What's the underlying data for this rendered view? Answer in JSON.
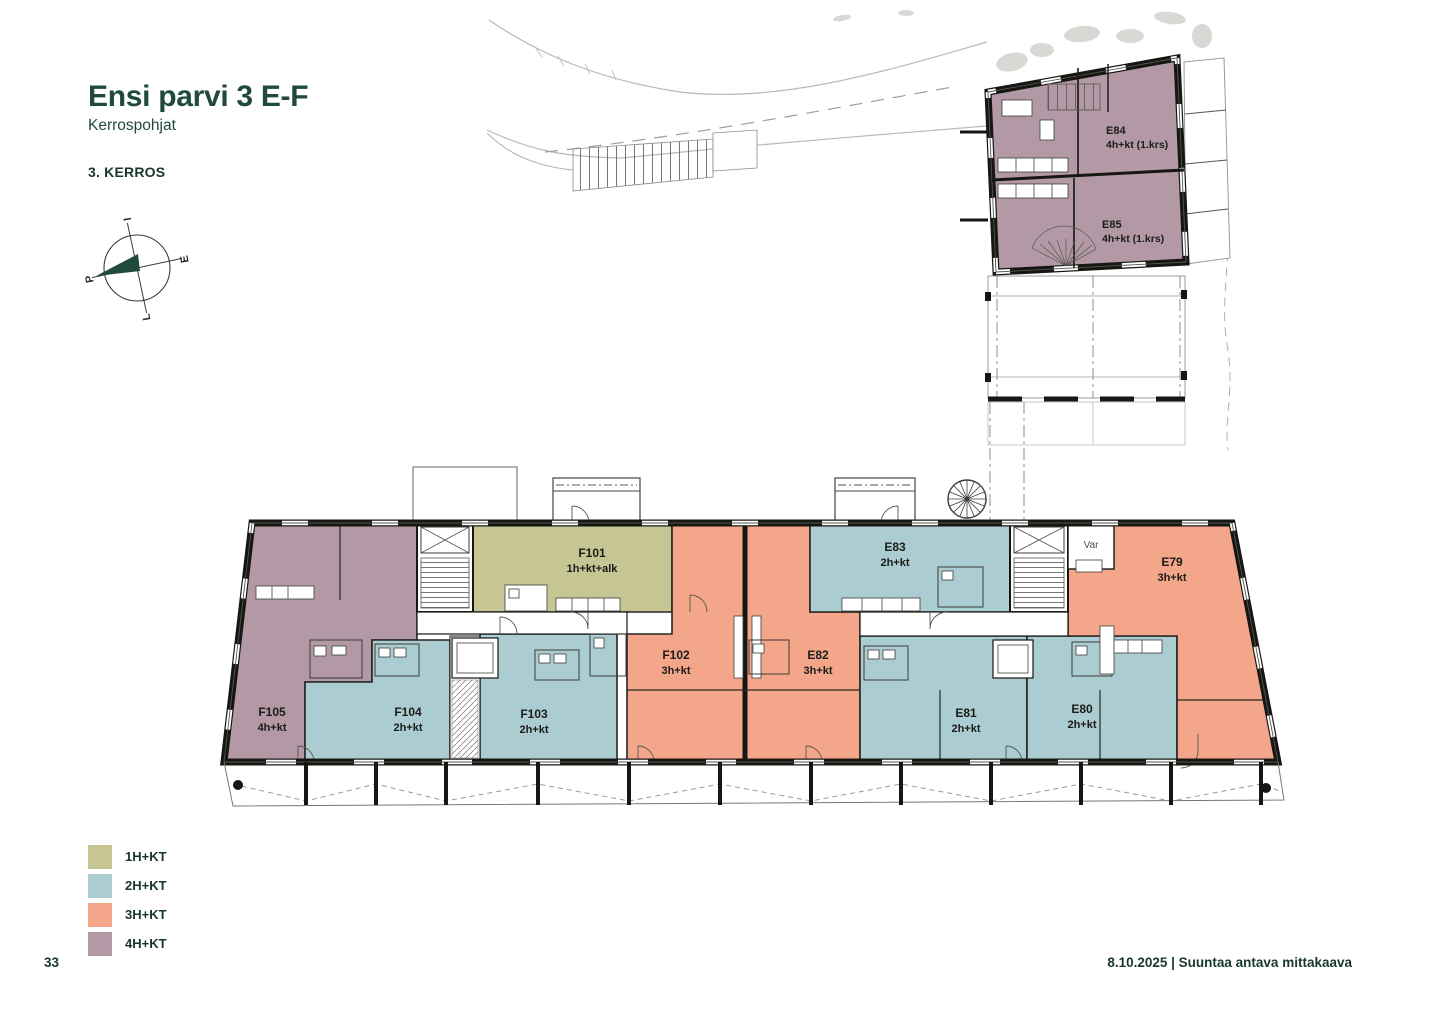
{
  "header": {
    "title": "Ensi parvi 3 E-F",
    "subtitle": "Kerrospohjat",
    "floor_label": "3. KERROS"
  },
  "compass": {
    "top": "I",
    "right": "E",
    "bottom": "L",
    "left": "P"
  },
  "upper_building": {
    "units": [
      {
        "id": "E84",
        "type": "4h+kt (1.krs)"
      },
      {
        "id": "E85",
        "type": "4h+kt (1.krs)"
      }
    ]
  },
  "main_building": {
    "storage_label": "Var",
    "units": [
      {
        "id": "F105",
        "type": "4h+kt"
      },
      {
        "id": "F104",
        "type": "2h+kt"
      },
      {
        "id": "F103",
        "type": "2h+kt"
      },
      {
        "id": "F101",
        "type": "1h+kt+alk"
      },
      {
        "id": "F102",
        "type": "3h+kt"
      },
      {
        "id": "E83",
        "type": "2h+kt"
      },
      {
        "id": "E82",
        "type": "3h+kt"
      },
      {
        "id": "E81",
        "type": "2h+kt"
      },
      {
        "id": "E80",
        "type": "2h+kt"
      },
      {
        "id": "E79",
        "type": "3h+kt"
      }
    ]
  },
  "legend": {
    "items": [
      {
        "label": "1H+KT",
        "color": "#c5c693"
      },
      {
        "label": "2H+KT",
        "color": "#abccd1"
      },
      {
        "label": "3H+KT",
        "color": "#f4a68a"
      },
      {
        "label": "4H+KT",
        "color": "#b299a5"
      }
    ]
  },
  "footer": {
    "page_number": "33",
    "right_text": "8.10.2025 | Suuntaa antava mittakaava"
  },
  "colors": {
    "accent_green": "#1f4a3d",
    "wall_black": "#161613"
  }
}
